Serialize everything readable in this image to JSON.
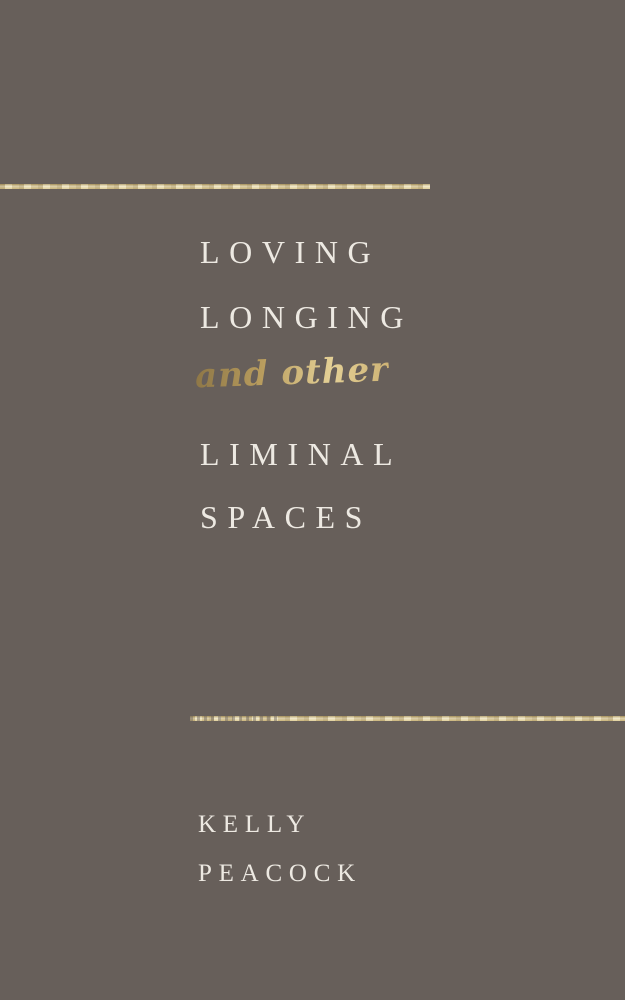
{
  "cover": {
    "title_lines": [
      "LOVING",
      "LONGING",
      "LIMINAL",
      "SPACES"
    ],
    "script_text": "and other",
    "author_lines": [
      "KELLY",
      "PEACOCK"
    ],
    "colors": {
      "background": "#675F5A",
      "title_text": "#EDE9E2",
      "script_gold": "#C7AC6D",
      "rule_gold_light": "#EFE6C6",
      "rule_gold_dark": "#A9945F"
    }
  }
}
